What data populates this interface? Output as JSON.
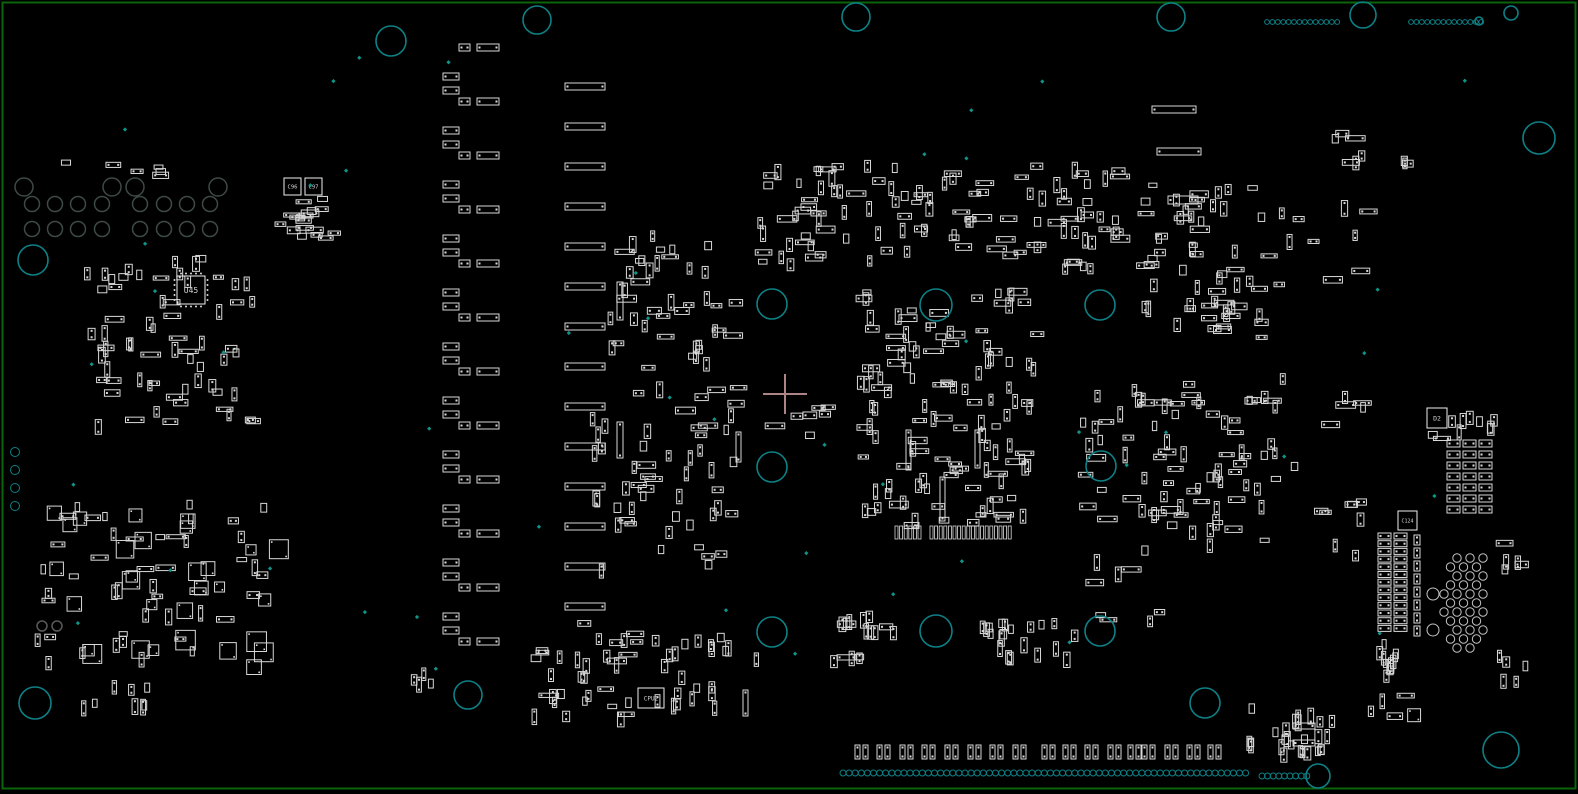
{
  "view": {
    "width": 1578,
    "height": 794,
    "description": "pcb-assembly-placement-view"
  },
  "colors": {
    "background": "#000000",
    "board_outline": "#0a650a",
    "component": "#d9d9d9",
    "component_bright": "#efefef",
    "hole": "#0d8186",
    "drill_gray": "#3e4a46",
    "drill_pair": "#5a5a5a",
    "via_white": "#c4c4c4",
    "test_point": "#0e9488",
    "crosshair": "#ad8484",
    "label": "#d6d6d6"
  },
  "board": {
    "inset": 2.5,
    "stroke_width": 2
  },
  "crosshair": {
    "x": 785,
    "y": 394,
    "arm_v": 20,
    "arm_h": 22,
    "stroke_width": 2
  },
  "reference_labels": [
    {
      "text": "U45",
      "box": [
        177,
        276,
        28,
        28
      ],
      "font": 8,
      "pins": true
    },
    {
      "text": "C96",
      "box": [
        284,
        178,
        17,
        17
      ],
      "font": 5.5,
      "pins": false
    },
    {
      "text": "C97",
      "box": [
        305,
        178,
        17,
        17
      ],
      "font": 5.5,
      "pins": false
    },
    {
      "text": "CPU2",
      "box": [
        638,
        688,
        26,
        20
      ],
      "font": 6,
      "pins": false
    },
    {
      "text": "D2",
      "box": [
        1427,
        408,
        20,
        20
      ],
      "font": 6.5,
      "pins": false
    },
    {
      "text": "C124",
      "box": [
        1398,
        511,
        19,
        19
      ],
      "font": 5,
      "pins": false
    }
  ],
  "mount_holes": [
    {
      "x": 391,
      "y": 41,
      "r": 15
    },
    {
      "x": 537,
      "y": 20,
      "r": 14
    },
    {
      "x": 856,
      "y": 17,
      "r": 14
    },
    {
      "x": 1171,
      "y": 17,
      "r": 14
    },
    {
      "x": 1363,
      "y": 15,
      "r": 13
    },
    {
      "x": 1511,
      "y": 13,
      "r": 7
    },
    {
      "x": 1479,
      "y": 21,
      "r": 4
    },
    {
      "x": 1539,
      "y": 138,
      "r": 16
    },
    {
      "x": 33,
      "y": 260,
      "r": 15
    },
    {
      "x": 772,
      "y": 304,
      "r": 15
    },
    {
      "x": 936,
      "y": 305,
      "r": 16
    },
    {
      "x": 1100,
      "y": 305,
      "r": 15
    },
    {
      "x": 772,
      "y": 467,
      "r": 15
    },
    {
      "x": 1101,
      "y": 466,
      "r": 15
    },
    {
      "x": 772,
      "y": 632,
      "r": 15
    },
    {
      "x": 936,
      "y": 631,
      "r": 16
    },
    {
      "x": 1100,
      "y": 631,
      "r": 15
    },
    {
      "x": 35,
      "y": 703,
      "r": 16
    },
    {
      "x": 468,
      "y": 695,
      "r": 14
    },
    {
      "x": 1205,
      "y": 703,
      "r": 15
    },
    {
      "x": 1318,
      "y": 776,
      "r": 12
    },
    {
      "x": 1501,
      "y": 750,
      "r": 18
    }
  ],
  "dot_rows": [
    {
      "x0": 1267,
      "y0": 22,
      "n": 14,
      "dx": 5.4,
      "dy": 0,
      "r": 2.4
    },
    {
      "x0": 1411,
      "y0": 22,
      "n": 14,
      "dx": 5.4,
      "dy": 0,
      "r": 2.4
    },
    {
      "x0": 843,
      "y0": 773,
      "n": 67,
      "dx": 6.1,
      "dy": 0,
      "r": 3
    },
    {
      "x0": 1262,
      "y0": 776,
      "n": 9,
      "dx": 5.6,
      "dy": 0,
      "r": 3
    },
    {
      "x0": 15,
      "y0": 452,
      "n": 4,
      "dx": 0,
      "dy": 18,
      "r": 4.5
    }
  ],
  "drill_gray_rows": [
    {
      "y": 187,
      "r": 9,
      "xs": [
        24,
        112,
        135,
        218
      ]
    },
    {
      "y": 204,
      "r": 7.5,
      "xs": [
        32,
        55,
        78,
        102,
        140,
        164,
        187,
        210
      ]
    },
    {
      "y": 229,
      "r": 7.5,
      "xs": [
        32,
        55,
        78,
        102,
        140,
        164,
        187,
        210
      ]
    }
  ],
  "drill_pair": [
    {
      "x": 42,
      "y": 626,
      "r": 5
    },
    {
      "x": 57,
      "y": 626,
      "r": 5
    }
  ],
  "via_honeycomb": {
    "r": 4.2,
    "rows": [
      {
        "y": 558,
        "xs": [
          1457,
          1470,
          1483
        ]
      },
      {
        "y": 567,
        "xs": [
          1450.5,
          1463.5,
          1476.5
        ]
      },
      {
        "y": 576,
        "xs": [
          1457,
          1470,
          1483
        ]
      },
      {
        "y": 585,
        "xs": [
          1450.5,
          1463.5,
          1476.5
        ]
      },
      {
        "y": 594,
        "xs": [
          1444,
          1457,
          1470,
          1483
        ]
      },
      {
        "y": 603,
        "xs": [
          1450.5,
          1463.5,
          1476.5
        ]
      },
      {
        "y": 612,
        "xs": [
          1444,
          1457,
          1470,
          1483
        ]
      },
      {
        "y": 621,
        "xs": [
          1450.5,
          1463.5,
          1476.5
        ]
      },
      {
        "y": 630,
        "xs": [
          1457,
          1470,
          1483
        ]
      },
      {
        "y": 639,
        "xs": [
          1450.5,
          1463.5,
          1476.5
        ]
      },
      {
        "y": 648,
        "xs": [
          1457,
          1470
        ]
      }
    ],
    "big": [
      {
        "x": 1433,
        "y": 594,
        "r": 6
      },
      {
        "x": 1433,
        "y": 630,
        "r": 6
      }
    ]
  },
  "bar_column_a": {
    "y0": 44,
    "period": 54,
    "count": 12,
    "pair_short": [
      459,
      11,
      7
    ],
    "pair_long": [
      477,
      22,
      7
    ],
    "single": [
      443,
      16,
      7
    ],
    "single_off": [
      29,
      43
    ]
  },
  "bar_column_c": {
    "x": 565,
    "w": 40,
    "h": 7,
    "y0": 83,
    "step": 40,
    "count": 14
  },
  "explicit_h_bars": [
    [
      1152,
      106,
      44,
      7
    ],
    [
      1157,
      148,
      44,
      7
    ],
    [
      1168,
      196,
      30,
      8
    ],
    [
      1293,
      723,
      22,
      6
    ],
    [
      1293,
      740,
      22,
      6
    ]
  ],
  "explicit_v_bars": [
    [
      617,
      282,
      6,
      38
    ],
    [
      617,
      422,
      6,
      36
    ],
    [
      906,
      430,
      5,
      40
    ],
    [
      975,
      430,
      5,
      38
    ],
    [
      940,
      477,
      5,
      44
    ],
    [
      736,
      432,
      5,
      30
    ],
    [
      743,
      690,
      5,
      26
    ]
  ],
  "pad_pair_row": {
    "y": 745,
    "w": 5,
    "h": 14,
    "gap": 8,
    "xs": [
      855,
      877,
      900,
      922,
      945,
      968,
      990,
      1013,
      1042,
      1063,
      1085,
      1108,
      1128,
      1142,
      1165,
      1187,
      1208
    ]
  },
  "dense_rows": [
    {
      "x0": 930,
      "y": 526,
      "n": 18,
      "dx": 4.6,
      "w": 3,
      "h": 13
    },
    {
      "x0": 895,
      "y": 526,
      "n": 6,
      "dx": 4.6,
      "w": 3,
      "h": 13
    }
  ],
  "pad_grids": [
    {
      "x0": 1447,
      "y0": 440,
      "cols": 3,
      "rows": 7,
      "dx": 16,
      "dy": 11,
      "w": 13,
      "h": 7
    },
    {
      "x0": 1378,
      "y0": 533,
      "cols": 2,
      "rows": 13,
      "dx": 16,
      "dy": 7.7,
      "w": 13,
      "h": 6
    },
    {
      "x0": 1414,
      "y0": 535,
      "cols": 1,
      "rows": 8,
      "dx": 0,
      "dy": 13,
      "w": 6,
      "h": 10
    }
  ],
  "clusters": [
    {
      "x": 80,
      "y": 255,
      "w": 180,
      "h": 165,
      "n": 65,
      "seed": 11,
      "kind": "mixed-small"
    },
    {
      "x": 35,
      "y": 500,
      "w": 235,
      "h": 165,
      "n": 75,
      "seed": 12,
      "kind": "mixed-squares"
    },
    {
      "x": 55,
      "y": 160,
      "w": 175,
      "h": 14,
      "n": 6,
      "seed": 13,
      "kind": "h-small"
    },
    {
      "x": 272,
      "y": 196,
      "w": 60,
      "h": 40,
      "n": 18,
      "seed": 14,
      "kind": "h-small"
    },
    {
      "x": 612,
      "y": 230,
      "w": 125,
      "h": 335,
      "n": 85,
      "seed": 15,
      "kind": "mixed-small"
    },
    {
      "x": 530,
      "y": 620,
      "w": 105,
      "h": 95,
      "n": 32,
      "seed": 16,
      "kind": "mixed-small"
    },
    {
      "x": 645,
      "y": 630,
      "w": 115,
      "h": 85,
      "n": 22,
      "seed": 17,
      "kind": "v-small"
    },
    {
      "x": 755,
      "y": 160,
      "w": 365,
      "h": 105,
      "n": 110,
      "seed": 18,
      "kind": "mixed-small"
    },
    {
      "x": 852,
      "y": 288,
      "w": 180,
      "h": 235,
      "n": 120,
      "seed": 19,
      "kind": "mixed-small"
    },
    {
      "x": 1078,
      "y": 380,
      "w": 85,
      "h": 240,
      "n": 38,
      "seed": 20,
      "kind": "mixed-small"
    },
    {
      "x": 1130,
      "y": 180,
      "w": 140,
      "h": 160,
      "n": 60,
      "seed": 21,
      "kind": "mixed-small"
    },
    {
      "x": 1158,
      "y": 380,
      "w": 115,
      "h": 160,
      "n": 52,
      "seed": 22,
      "kind": "mixed-small"
    },
    {
      "x": 1272,
      "y": 360,
      "w": 90,
      "h": 200,
      "n": 16,
      "seed": 23,
      "kind": "mixed-small"
    },
    {
      "x": 828,
      "y": 608,
      "w": 80,
      "h": 48,
      "n": 16,
      "seed": 24,
      "kind": "mixed-small"
    },
    {
      "x": 975,
      "y": 615,
      "w": 100,
      "h": 40,
      "n": 20,
      "seed": 25,
      "kind": "v-small"
    },
    {
      "x": 1245,
      "y": 700,
      "w": 85,
      "h": 55,
      "n": 26,
      "seed": 26,
      "kind": "v-small"
    },
    {
      "x": 1372,
      "y": 638,
      "w": 25,
      "h": 62,
      "n": 12,
      "seed": 27,
      "kind": "v-small"
    },
    {
      "x": 1320,
      "y": 112,
      "w": 90,
      "h": 55,
      "n": 9,
      "seed": 28,
      "kind": "mixed-small"
    },
    {
      "x": 1270,
      "y": 200,
      "w": 110,
      "h": 110,
      "n": 10,
      "seed": 29,
      "kind": "mixed-small"
    },
    {
      "x": 1440,
      "y": 408,
      "w": 55,
      "h": 18,
      "n": 8,
      "seed": 30,
      "kind": "v-small"
    },
    {
      "x": 405,
      "y": 655,
      "w": 30,
      "h": 28,
      "n": 4,
      "seed": 32,
      "kind": "v-small"
    },
    {
      "x": 1493,
      "y": 528,
      "w": 40,
      "h": 45,
      "n": 5,
      "seed": 33,
      "kind": "mixed-squares"
    },
    {
      "x": 1497,
      "y": 645,
      "w": 28,
      "h": 38,
      "n": 5,
      "seed": 34,
      "kind": "v-small"
    },
    {
      "x": 1368,
      "y": 692,
      "w": 50,
      "h": 28,
      "n": 4,
      "seed": 35,
      "kind": "mixed-squares"
    },
    {
      "x": 75,
      "y": 680,
      "w": 70,
      "h": 22,
      "n": 8,
      "seed": 36,
      "kind": "v-small"
    },
    {
      "x": 588,
      "y": 275,
      "w": 22,
      "h": 290,
      "n": 10,
      "seed": 37,
      "kind": "v-small"
    },
    {
      "x": 758,
      "y": 388,
      "w": 66,
      "h": 52,
      "n": 7,
      "seed": 38,
      "kind": "h-small"
    },
    {
      "x": 1420,
      "y": 428,
      "w": 20,
      "h": 10,
      "n": 2,
      "seed": 31,
      "kind": "h-small"
    }
  ],
  "test_points": {
    "seed": 40,
    "count": 46,
    "region": [
      35,
      55,
      1485,
      675
    ],
    "size": 3
  }
}
